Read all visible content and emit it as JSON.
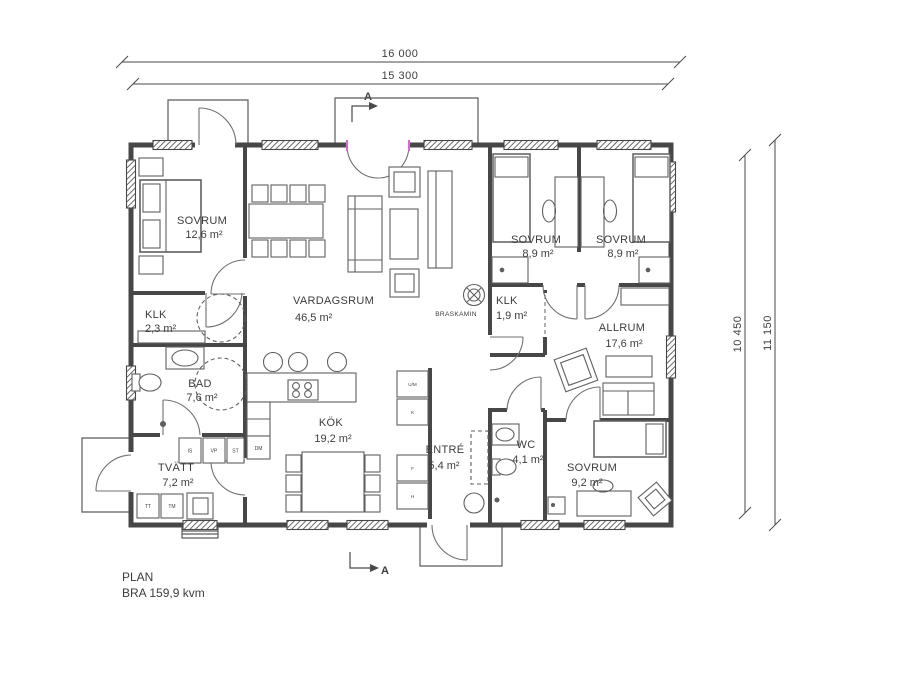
{
  "footer": {
    "plan": "PLAN",
    "area": "BRA 159,9 kvm"
  },
  "dimensions": {
    "top_outer": "16 000",
    "top_inner": "15 300",
    "right_inner": "10 450",
    "right_outer": "11 150"
  },
  "section_marker": {
    "label": "A"
  },
  "rooms": {
    "sovrum_1": {
      "name": "SOVRUM",
      "area": "12,6 m²"
    },
    "klk_1": {
      "name": "KLK",
      "area": "2,3 m²"
    },
    "bad": {
      "name": "BAD",
      "area": "7,6 m²"
    },
    "tvatt": {
      "name": "TVÄTT",
      "area": "7,2 m²"
    },
    "vardagsrum": {
      "name": "VARDAGSRUM",
      "area": "46,5 m²"
    },
    "kok": {
      "name": "KÖK",
      "area": "19,2 m²"
    },
    "entre": {
      "name": "ENTRÉ",
      "area": "5,4 m²"
    },
    "sovrum_2": {
      "name": "SOVRUM",
      "area": "8,9 m²"
    },
    "sovrum_3": {
      "name": "SOVRUM",
      "area": "8,9 m²"
    },
    "klk_2": {
      "name": "KLK",
      "area": "1,9 m²"
    },
    "allrum": {
      "name": "ALLRUM",
      "area": "17,6 m²"
    },
    "wc": {
      "name": "WC",
      "area": "4,1 m²"
    },
    "sovrum_4": {
      "name": "SOVRUM",
      "area": "9,2 m²"
    }
  },
  "fixtures": {
    "braskamin": "BRASKAMIN"
  },
  "appliances": {
    "is": "IS",
    "vp": "VP",
    "st": "ST",
    "dm": "DM",
    "tt": "TT",
    "tm": "TM",
    "um": "U/M",
    "k": "K",
    "f": "F",
    "h": "H"
  },
  "colors": {
    "line": "#4a4a4a",
    "appliance_blue": "#4aa0d6",
    "door_magenta": "#c873c8"
  }
}
